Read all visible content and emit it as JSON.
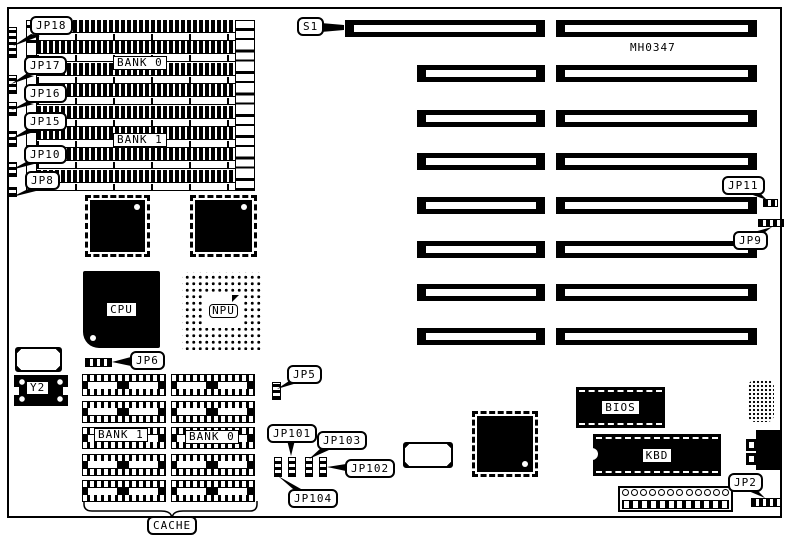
{
  "board": {
    "part_number": "MH0347"
  },
  "callouts": {
    "s1": "S1",
    "jp18": "JP18",
    "jp17": "JP17",
    "jp16": "JP16",
    "jp15": "JP15",
    "jp10": "JP10",
    "jp8": "JP8",
    "jp11": "JP11",
    "jp9": "JP9",
    "jp6": "JP6",
    "jp5": "JP5",
    "jp101": "JP101",
    "jp103": "JP103",
    "jp102": "JP102",
    "jp104": "JP104",
    "jp2": "JP2",
    "cache": "CACHE"
  },
  "components": {
    "simm_bank0": "BANK 0",
    "simm_bank1": "BANK 1",
    "cpu": "CPU",
    "npu": "NPU",
    "y2": "Y2",
    "cache_bank1": "BANK 1",
    "cache_bank0": "BANK 0",
    "bios": "BIOS",
    "kbd": "KBD"
  }
}
